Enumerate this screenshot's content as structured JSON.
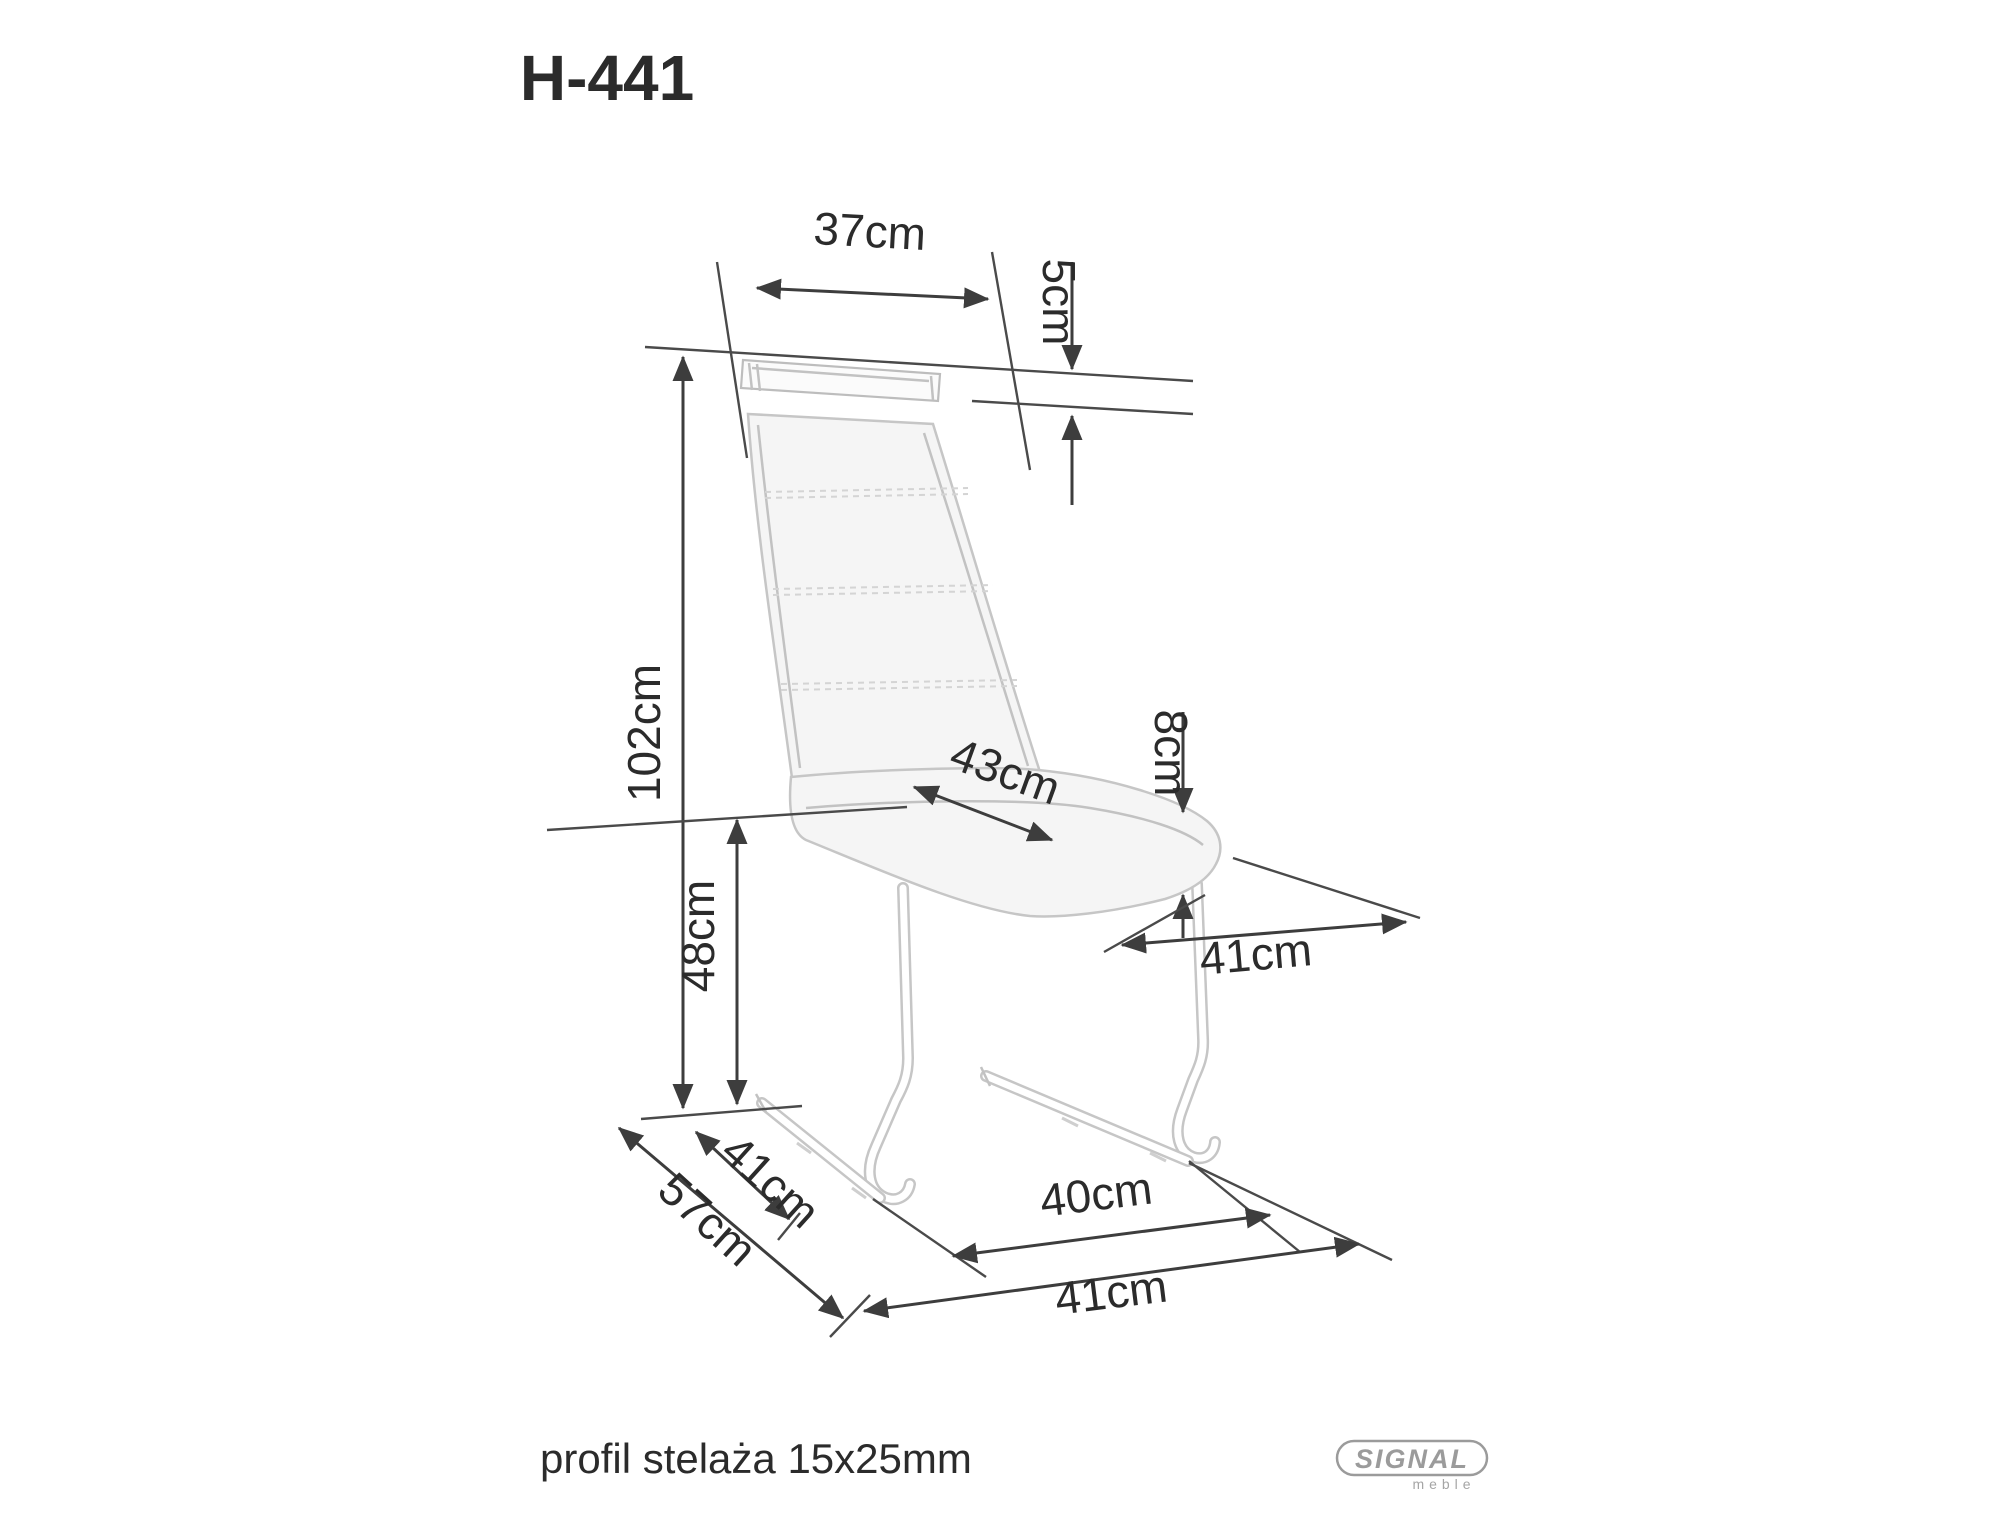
{
  "title": "H-441",
  "dimensions": {
    "backrest_width": "37cm",
    "handle_gap_height": "5cm",
    "total_height": "102cm",
    "seat_height": "48cm",
    "seat_width": "43cm",
    "seat_cushion_thickness": "8cm",
    "seat_depth": "41cm",
    "base_side_depth": "41cm",
    "total_depth": "57cm",
    "base_inner_width": "40cm",
    "base_width": "41cm"
  },
  "footer": {
    "note": "profil stelaża 15x25mm"
  },
  "logo": {
    "brand": "SIGNAL",
    "sub": "meble"
  },
  "colors": {
    "background": "#ffffff",
    "dimension_lines": "#3d3d3d",
    "label_text": "#2b2b2b",
    "chair_outline": "#c2c2c2",
    "chair_fill": "#f5f5f5",
    "logo_gray": "#9b9b9b"
  }
}
